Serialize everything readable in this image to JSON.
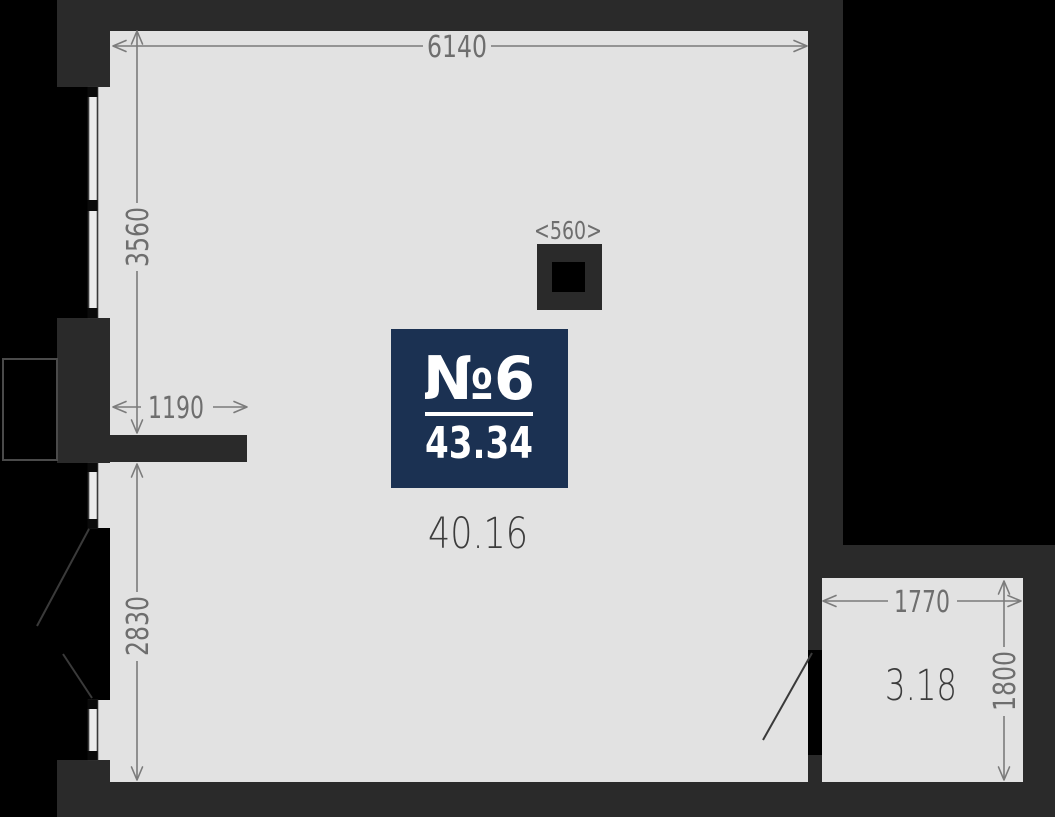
{
  "floor_plan": {
    "badge": {
      "unit_label": "№6",
      "total_area": "43.34"
    },
    "areas": {
      "main_room": "40.16",
      "small_room": "3.18"
    },
    "dimensions": {
      "top_width": "6140",
      "left_upper_height": "3560",
      "left_stub_width": "1190",
      "left_lower_height": "2830",
      "column_width": "<560>",
      "small_room_width": "1770",
      "small_room_height": "1800"
    },
    "colors": {
      "background": "#000000",
      "wall": "#2a2a2a",
      "floor": "#e2e2e2",
      "badge": "#1b3152",
      "badge_text": "#ffffff",
      "dimension_text": "#6e6e6e",
      "dimension_line": "#7b7b7b",
      "area_text": "#3c3c3c",
      "frame_line": "#3a3a3a"
    }
  }
}
